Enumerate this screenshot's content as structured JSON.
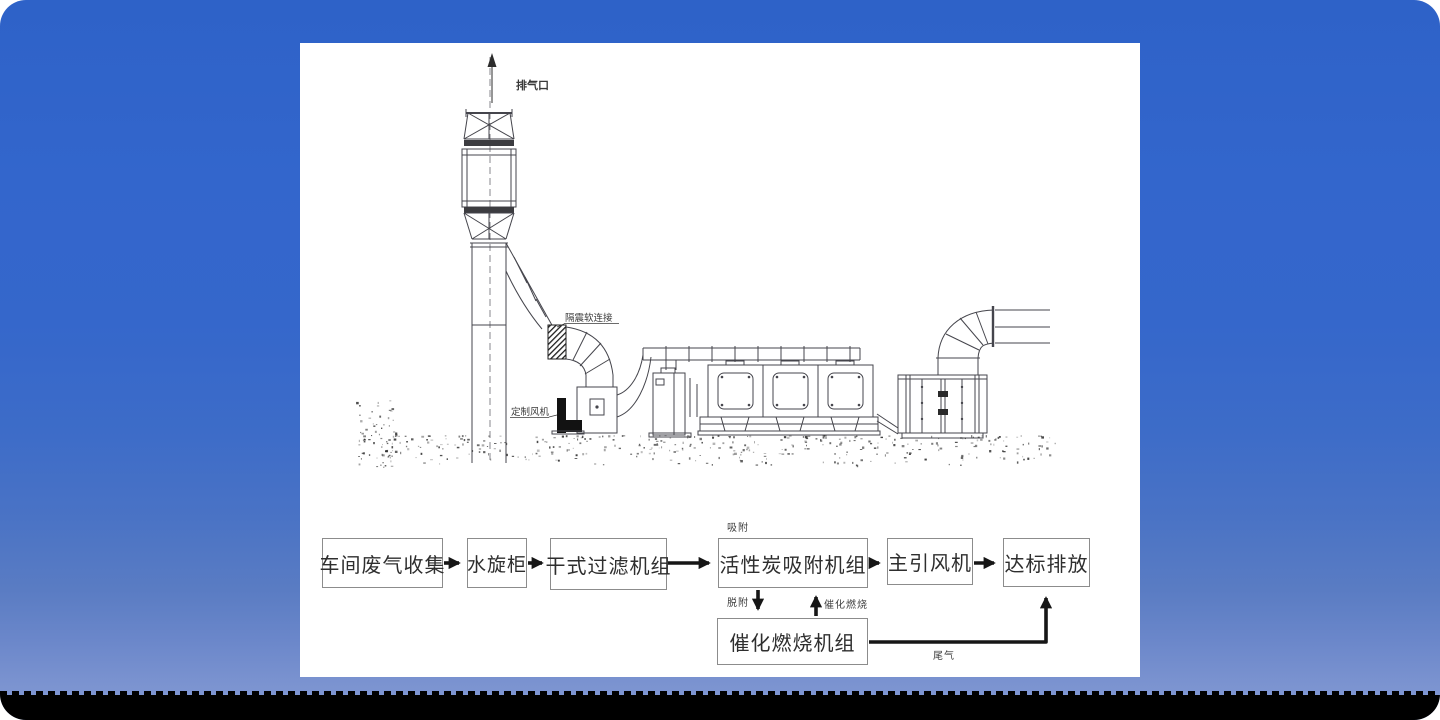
{
  "window": {
    "background_top_color": "#3366cc",
    "background_bottom_color": "#8399d5",
    "bottom_band_color": "#000000",
    "panel_color": "#ffffff"
  },
  "drawing": {
    "exhaust_outlet": "排气口",
    "flex_connector": "隔震软连接",
    "custom_fan": "定制风机"
  },
  "flowchart": {
    "boxes": [
      {
        "label": "车间废气收集"
      },
      {
        "label": "水旋柜"
      },
      {
        "label": "干式过滤机组"
      },
      {
        "label": "活性炭吸附机组"
      },
      {
        "label": "主引风机"
      },
      {
        "label": "达标排放"
      },
      {
        "label": "催化燃烧机组"
      }
    ],
    "labels": {
      "adsorption": "吸附",
      "desorption": "脱附",
      "catalytic_combustion": "催化燃烧",
      "tail_gas": "尾气"
    },
    "arrow_color": "#161616",
    "box_border_color": "#8c8c8c",
    "text_color": "#2e2e2e"
  }
}
